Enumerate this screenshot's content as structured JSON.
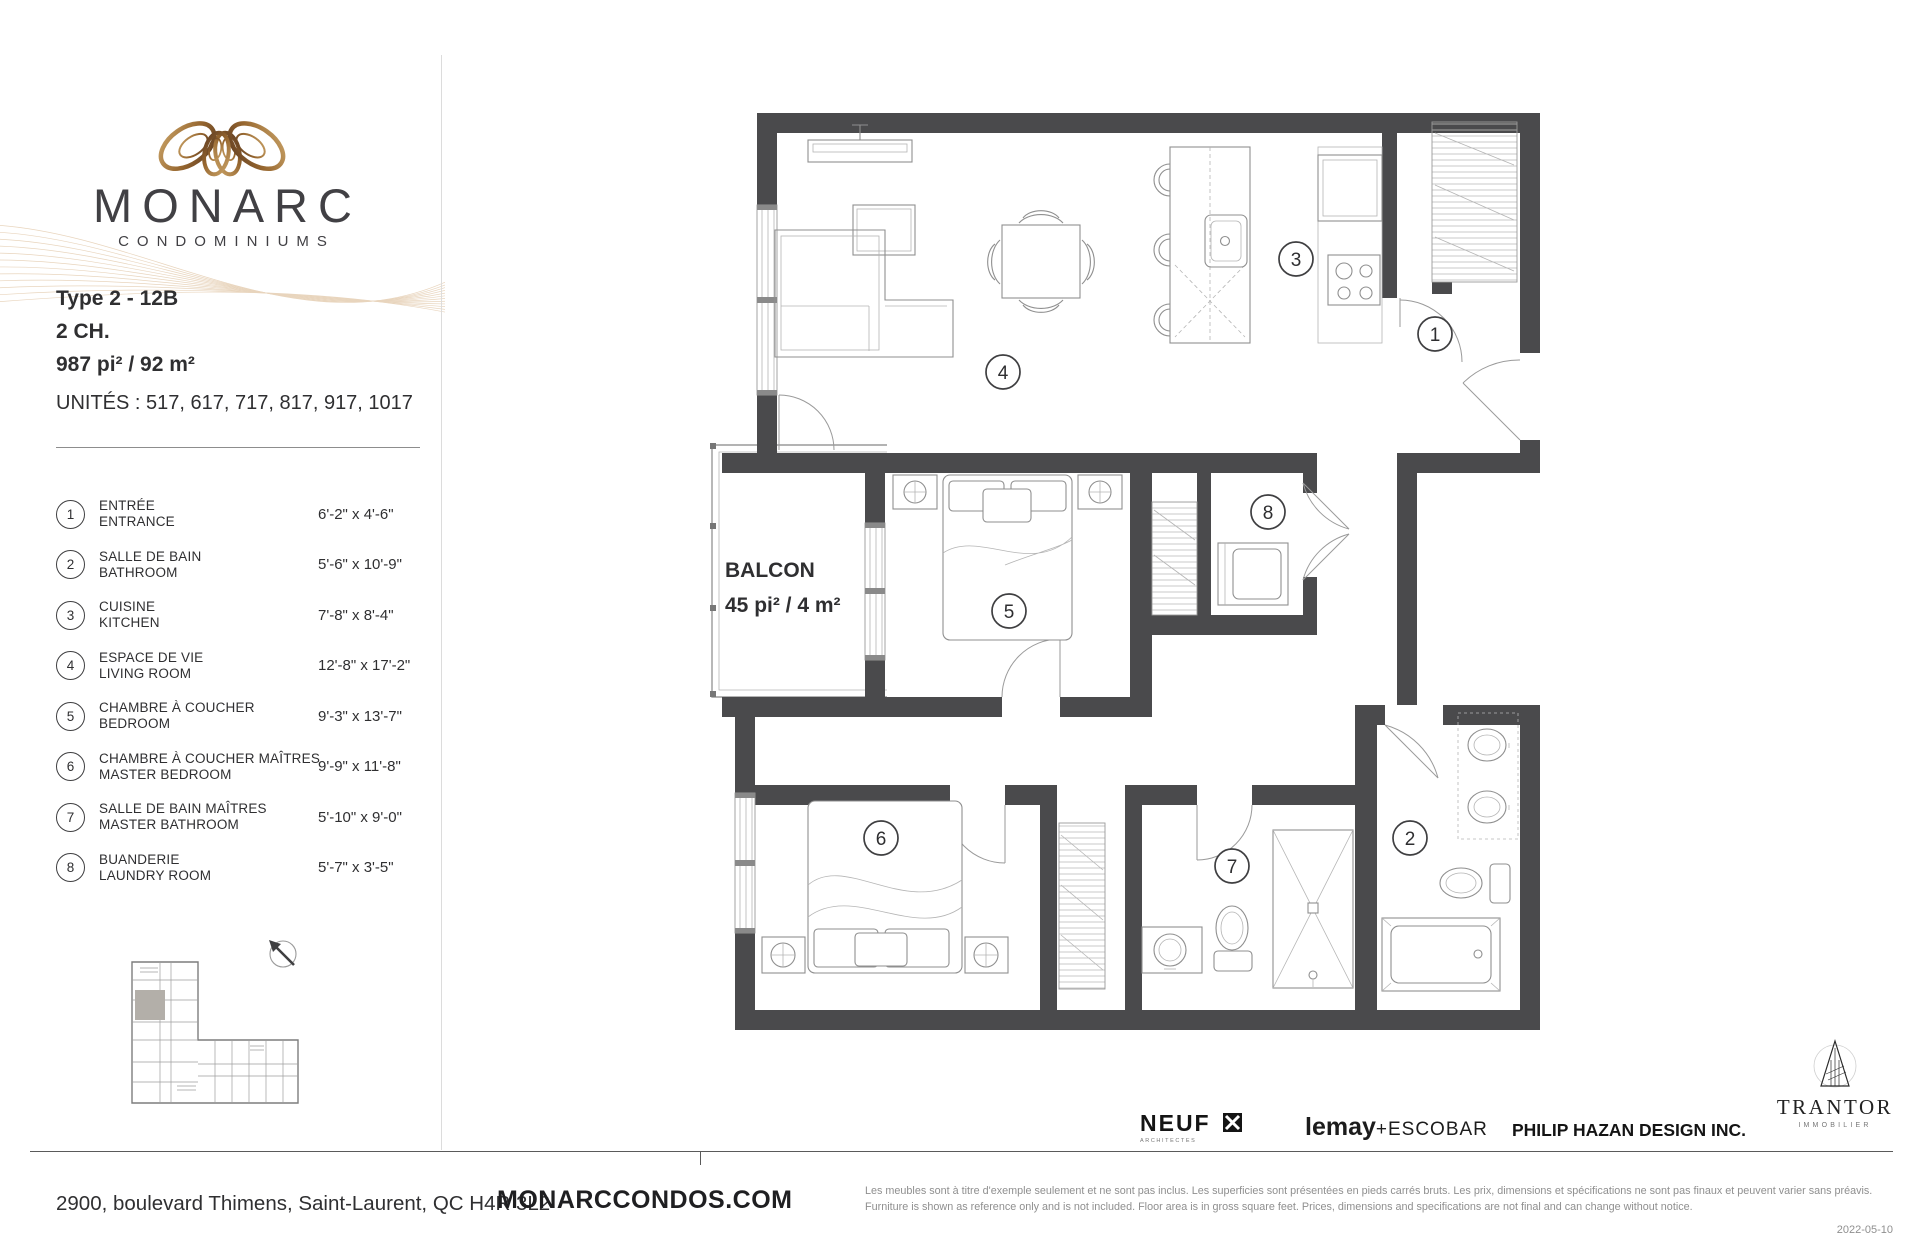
{
  "brand": {
    "name": "MONARC",
    "tagline": "CONDOMINIUMS"
  },
  "unit": {
    "type": "Type 2 - 12B",
    "bedrooms": "2 CH.",
    "area": "987 pi² / 92 m²",
    "units_label": "UNITÉS : 517, 617, 717, 817, 917, 1017"
  },
  "legend": {
    "items": [
      {
        "num": "1",
        "fr": "ENTRÉE",
        "en": "ENTRANCE",
        "dim": "6'-2\" x 4'-6\""
      },
      {
        "num": "2",
        "fr": "SALLE DE BAIN",
        "en": "BATHROOM",
        "dim": "5'-6\" x 10'-9\""
      },
      {
        "num": "3",
        "fr": "CUISINE",
        "en": "KITCHEN",
        "dim": "7'-8\" x 8'-4\""
      },
      {
        "num": "4",
        "fr": "ESPACE DE VIE",
        "en": "LIVING ROOM",
        "dim": "12'-8\" x 17'-2\""
      },
      {
        "num": "5",
        "fr": "CHAMBRE À COUCHER",
        "en": "BEDROOM",
        "dim": "9'-3\" x 13'-7\""
      },
      {
        "num": "6",
        "fr": "CHAMBRE À COUCHER MAÎTRES",
        "en": "MASTER BEDROOM",
        "dim": "9'-9\" x 11'-8\""
      },
      {
        "num": "7",
        "fr": "SALLE DE BAIN MAÎTRES",
        "en": "MASTER BATHROOM",
        "dim": "5'-10\" x 9'-0\""
      },
      {
        "num": "8",
        "fr": "BUANDERIE",
        "en": "LAUNDRY ROOM",
        "dim": "5'-7\" x 3'-5\""
      }
    ]
  },
  "plan": {
    "balcony_label": "BALCON",
    "balcony_area": "45 pi² / 4 m²"
  },
  "footer": {
    "address": "2900, boulevard Thimens, Saint-Laurent, QC  H4R 3L2",
    "website": "MONARCCONDOS.COM",
    "disclaimer_fr": "Les meubles sont à titre d'exemple seulement et ne sont pas inclus. Les superficies sont présentées en pieds carrés bruts. Les prix, dimensions et spécifications ne sont pas finaux et peuvent varier sans préavis.",
    "disclaimer_en": "Furniture is shown as reference only and is not included. Floor area is in gross square feet. Prices, dimensions and specifications are not final and can change without notice.",
    "date": "2022-05-10"
  },
  "partners": {
    "neuf": "NEUF",
    "neuf_sub": "ARCHITECTES",
    "lemay": "lemay",
    "escobar": "+ESCOBAR",
    "hazan": "PHILIP HAZAN DESIGN INC.",
    "trantor": "TRANTOR",
    "trantor_sub": "IMMOBILIER"
  },
  "colors": {
    "wall": "#4a4a4c",
    "accent_gold": "#b08d57",
    "highlight_unit": "#b3afa9"
  }
}
